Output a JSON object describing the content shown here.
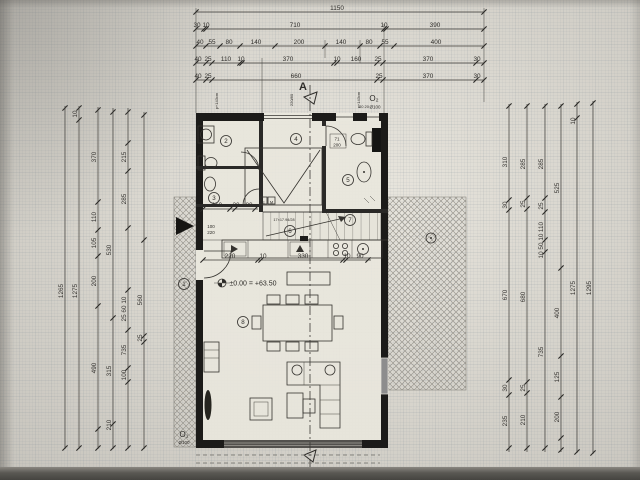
{
  "sheet": {
    "type": "architectural-floor-plan",
    "section_letter": "A",
    "level_marker_text": "±0.00 = +63.50",
    "opening_top": {
      "label": "O₂",
      "note": "Ø100"
    },
    "opening_bottom": {
      "label": "O₁",
      "note": "Ø100"
    },
    "stair_note": "17×17.94/28",
    "colors": {
      "paper": "#d6d3cb",
      "ink": "#35332f",
      "wall": "#1c1b19",
      "glass": "#8d8d8d",
      "hatch": "#97948b"
    }
  },
  "drawing": {
    "h_chains": [
      {
        "y": 12,
        "x1": 196,
        "x2": 484,
        "ticks": [
          196,
          484
        ],
        "labels": [
          {
            "x": 337,
            "t": "1150"
          }
        ]
      },
      {
        "y": 29,
        "x1": 196,
        "x2": 484,
        "ticks": [
          196,
          204,
          206,
          384,
          386,
          484
        ],
        "labels": [
          {
            "x": 197,
            "t": "30"
          },
          {
            "x": 206,
            "t": "10"
          },
          {
            "x": 295,
            "t": "710"
          },
          {
            "x": 384,
            "t": "10"
          },
          {
            "x": 435,
            "t": "390"
          }
        ]
      },
      {
        "y": 46,
        "x1": 196,
        "x2": 484,
        "ticks": [
          196,
          206,
          220,
          240,
          275,
          325,
          360,
          380,
          394,
          484
        ],
        "labels": [
          {
            "x": 200,
            "t": "40"
          },
          {
            "x": 212,
            "t": "55"
          },
          {
            "x": 229,
            "t": "80"
          },
          {
            "x": 256,
            "t": "140"
          },
          {
            "x": 299,
            "t": "200"
          },
          {
            "x": 341,
            "t": "140"
          },
          {
            "x": 369,
            "t": "80"
          },
          {
            "x": 385,
            "t": "55"
          },
          {
            "x": 436,
            "t": "400"
          }
        ]
      },
      {
        "y": 63,
        "x1": 196,
        "x2": 484,
        "ticks": [
          196,
          206,
          212,
          240,
          242,
          334,
          337,
          377,
          383,
          476,
          484
        ],
        "labels": [
          {
            "x": 198,
            "t": "40"
          },
          {
            "x": 208,
            "t": "25"
          },
          {
            "x": 226,
            "t": "110"
          },
          {
            "x": 241,
            "t": "10"
          },
          {
            "x": 288,
            "t": "370"
          },
          {
            "x": 337,
            "t": "10"
          },
          {
            "x": 356,
            "t": "160"
          },
          {
            "x": 378,
            "t": "25"
          },
          {
            "x": 428,
            "t": "370"
          },
          {
            "x": 477,
            "t": "30"
          }
        ]
      },
      {
        "y": 80,
        "x1": 196,
        "x2": 484,
        "ticks": [
          196,
          206,
          212,
          377,
          383,
          476,
          484
        ],
        "labels": [
          {
            "x": 198,
            "t": "40"
          },
          {
            "x": 208,
            "t": "25"
          },
          {
            "x": 296,
            "t": "660"
          },
          {
            "x": 379,
            "t": "25"
          },
          {
            "x": 428,
            "t": "370"
          },
          {
            "x": 477,
            "t": "30"
          }
        ]
      },
      {
        "y": 209,
        "x1": 203,
        "x2": 258,
        "ticks": [
          203,
          230,
          235,
          255
        ],
        "labels": [
          {
            "x": 217,
            "t": "110"
          },
          {
            "x": 236,
            "t": "20"
          },
          {
            "x": 249,
            "t": "80"
          }
        ]
      },
      {
        "y": 260,
        "x1": 203,
        "x2": 371,
        "ticks": [
          203,
          258,
          261,
          343,
          346,
          368
        ],
        "labels": [
          {
            "x": 230,
            "t": "220"
          },
          {
            "x": 263,
            "t": "10"
          },
          {
            "x": 303,
            "t": "330"
          },
          {
            "x": 347,
            "t": "10"
          },
          {
            "x": 360,
            "t": "90"
          }
        ]
      }
    ],
    "v_chains": [
      {
        "x": 65,
        "y1": 106,
        "y2": 449,
        "ticks": [
          108,
          448
        ],
        "labels": [
          {
            "y": 291,
            "t": "1265"
          }
        ]
      },
      {
        "x": 79,
        "y1": 106,
        "y2": 449,
        "ticks": [
          108,
          120,
          448
        ],
        "labels": [
          {
            "y": 114,
            "t": "10"
          },
          {
            "y": 291,
            "t": "1275"
          }
        ]
      },
      {
        "x": 98,
        "y1": 107,
        "y2": 449,
        "ticks": [
          110,
          202,
          230,
          256,
          306,
          429,
          448
        ],
        "labels": [
          {
            "y": 157,
            "t": "370"
          },
          {
            "y": 217,
            "t": "110"
          },
          {
            "y": 243,
            "t": "105"
          },
          {
            "y": 281,
            "t": "200"
          },
          {
            "y": 368,
            "t": "490"
          }
        ]
      },
      {
        "x": 113,
        "y1": 108,
        "y2": 449,
        "ticks": [
          112,
          318,
          424,
          448
        ],
        "labels": [
          {
            "y": 250,
            "t": "530"
          },
          {
            "y": 371,
            "t": "315"
          },
          {
            "y": 425,
            "t": "210"
          }
        ]
      },
      {
        "x": 128,
        "y1": 108,
        "y2": 449,
        "ticks": [
          112,
          143,
          171,
          228,
          290,
          330,
          368,
          382,
          448
        ],
        "labels": [
          {
            "y": 157,
            "t": "215"
          },
          {
            "y": 199,
            "t": "285"
          },
          {
            "y": 309,
            "t": "25 60 10"
          },
          {
            "y": 350,
            "t": "735"
          },
          {
            "y": 375,
            "t": "100"
          }
        ]
      },
      {
        "x": 144,
        "y1": 112,
        "y2": 449,
        "ticks": [
          115,
          240,
          336,
          342,
          448
        ],
        "labels": [
          {
            "y": 300,
            "t": "560"
          },
          {
            "y": 338,
            "t": "25"
          }
        ]
      },
      {
        "x": 509,
        "y1": 104,
        "y2": 452,
        "ticks": [
          106,
          200,
          210,
          380,
          395,
          448
        ],
        "labels": [
          {
            "y": 162,
            "t": "310"
          },
          {
            "y": 205,
            "t": "30"
          },
          {
            "y": 295,
            "t": "670"
          },
          {
            "y": 388,
            "t": "30"
          },
          {
            "y": 421,
            "t": "235"
          }
        ]
      },
      {
        "x": 527,
        "y1": 104,
        "y2": 452,
        "ticks": [
          106,
          198,
          209,
          382,
          393,
          448
        ],
        "labels": [
          {
            "y": 164,
            "t": "285"
          },
          {
            "y": 204,
            "t": "25"
          },
          {
            "y": 297,
            "t": "680"
          },
          {
            "y": 388,
            "t": "25"
          },
          {
            "y": 420,
            "t": "210"
          }
        ]
      },
      {
        "x": 545,
        "y1": 104,
        "y2": 452,
        "ticks": [
          106,
          198,
          212,
          240,
          252,
          448
        ],
        "labels": [
          {
            "y": 164,
            "t": "285"
          },
          {
            "y": 206,
            "t": "25"
          },
          {
            "y": 227,
            "t": "110"
          },
          {
            "y": 246,
            "t": "10 50 10"
          },
          {
            "y": 352,
            "t": "735"
          }
        ]
      },
      {
        "x": 561,
        "y1": 104,
        "y2": 452,
        "ticks": [
          106,
          268,
          356,
          397,
          438,
          450
        ],
        "labels": [
          {
            "y": 188,
            "t": "525"
          },
          {
            "y": 313,
            "t": "400"
          },
          {
            "y": 377,
            "t": "125"
          },
          {
            "y": 417,
            "t": "200"
          }
        ]
      },
      {
        "x": 577,
        "y1": 102,
        "y2": 453,
        "ticks": [
          104,
          118,
          452
        ],
        "labels": [
          {
            "y": 121,
            "t": "10"
          },
          {
            "y": 288,
            "t": "1275"
          }
        ]
      },
      {
        "x": 593,
        "y1": 101,
        "y2": 454,
        "ticks": [
          103,
          453
        ],
        "labels": [
          {
            "y": 288,
            "t": "1295"
          }
        ]
      }
    ],
    "annotations": [
      {
        "x": 303,
        "y": 90,
        "t": "A",
        "size": 11,
        "bold": true,
        "name": "section-letter"
      },
      {
        "x": 374,
        "y": 101,
        "t": "O₂",
        "size": 8,
        "name": "opening-label-top"
      },
      {
        "x": 375,
        "y": 108.5,
        "t": "Ø100",
        "size": 4.5,
        "name": "opening-diameter-top"
      },
      {
        "x": 184,
        "y": 437,
        "t": "O₁",
        "size": 8,
        "name": "opening-label-bottom"
      },
      {
        "x": 184,
        "y": 444,
        "t": "Ø100",
        "size": 4.5,
        "name": "opening-diameter-bottom"
      },
      {
        "x": 253,
        "y": 285.5,
        "t": "±0.00 = +63.50",
        "size": 7,
        "name": "level-marker-text"
      },
      {
        "x": 218,
        "y": 101,
        "t": "p+143cm",
        "size": 4,
        "rot": -90,
        "name": "parapet-label"
      },
      {
        "x": 293,
        "y": 100,
        "t": "220/80",
        "size": 4,
        "rot": -90,
        "name": "window-size-label"
      },
      {
        "x": 360,
        "y": 100,
        "t": "p+143cm",
        "size": 4,
        "rot": -90,
        "name": "parapet-label"
      },
      {
        "x": 364,
        "y": 108,
        "t": "20 20",
        "size": 4
      },
      {
        "x": 337,
        "y": 140.5,
        "t": "71",
        "size": 4.5,
        "name": "door-size-label"
      },
      {
        "x": 337,
        "y": 146.5,
        "t": "200",
        "size": 4.5,
        "name": "door-size-label"
      },
      {
        "x": 211,
        "y": 228,
        "t": "100",
        "size": 4.5,
        "name": "door-size-label"
      },
      {
        "x": 211,
        "y": 234,
        "t": "220",
        "size": 4.5,
        "name": "door-size-label"
      },
      {
        "x": 284,
        "y": 221,
        "t": "17×17.94/28",
        "size": 3.8,
        "name": "stair-note"
      },
      {
        "x": 263.5,
        "y": 203.5,
        "t": "E",
        "size": 4,
        "name": "meter-box-label"
      },
      {
        "x": 271.5,
        "y": 203.5,
        "t": "M",
        "size": 4,
        "name": "meter-box-label"
      }
    ],
    "rooms": [
      {
        "n": "1",
        "x": 184,
        "y": 284
      },
      {
        "n": "2",
        "x": 226,
        "y": 141
      },
      {
        "n": "3",
        "x": 214,
        "y": 198
      },
      {
        "n": "4",
        "x": 296,
        "y": 139
      },
      {
        "n": "5",
        "x": 348,
        "y": 180
      },
      {
        "n": "6",
        "x": 290,
        "y": 231
      },
      {
        "n": "7",
        "x": 350,
        "y": 220
      },
      {
        "n": "8",
        "x": 243,
        "y": 322
      }
    ]
  }
}
